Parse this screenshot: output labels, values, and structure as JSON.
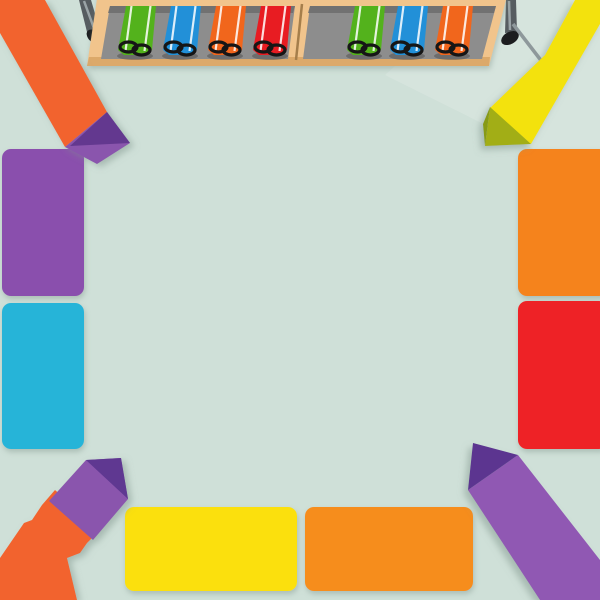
{
  "scene": {
    "description_visible_objects": {
      "marker_caddy": {
        "left_tray_markers": [
          "green",
          "blue",
          "orange",
          "red"
        ],
        "right_tray_markers": [
          "green",
          "blue",
          "orange"
        ],
        "right_tray_has_empty_slot": true
      },
      "table_legs": [
        "left",
        "right"
      ],
      "blocks": {
        "left_edge": [
          "purple",
          "cyan"
        ],
        "right_edge": [
          "orange",
          "red"
        ],
        "bottom_edge": [
          "yellow",
          "orange"
        ]
      },
      "crayons": {
        "top_left": "orange body, purple tip",
        "top_right": "yellow body, olive tip",
        "bottom_left": "orange body, purple tip",
        "bottom_right": "purple body, dark purple tip"
      }
    }
  },
  "colors": {
    "background": "#cfe0d8",
    "background_highlight": "#dde8e2",
    "shelf_wood": "#f1c48c",
    "shelf_wood_shadow": "#dca96a",
    "shelf_interior": "#8d8d8d",
    "shelf_interior_shadow": "#6e6e6e",
    "divider_seam": "#a57e4b",
    "leg": "#565c60",
    "leg_highlight": "#9aa3a6",
    "leg_foot": "#1c1d1f",
    "leg_bar": "#8e989b",
    "leg_bar_cap": "#3a3e40",
    "marker_green": "#53b21c",
    "marker_blue": "#2090d8",
    "marker_orange": "#f1661f",
    "marker_red": "#e81b20",
    "marker_stripe": "#ffffff",
    "marker_clip": "#141414",
    "marker_shadow": "#4c4c4c",
    "block_purple": "#8a50ad",
    "block_cyan": "#28b4d8",
    "block_orange_right": "#f5831c",
    "block_red": "#ee2425",
    "block_yellow": "#fbe00e",
    "block_orange_bottom": "#f68d1e",
    "crayon_orange": "#f2642d",
    "crayon_tip_purple_light": "#8a55ad",
    "crayon_tip_purple_dark": "#63398f",
    "crayon_tip_purple_darker": "#5e3791",
    "crayon_yellow": "#f3e20c",
    "crayon_tip_olive": "#a2ae15",
    "crayon_tip_olive_dark": "#879a12",
    "crayon_purple_body": "#9059b3",
    "crayon_purple_tip_dark": "#5b3690"
  }
}
